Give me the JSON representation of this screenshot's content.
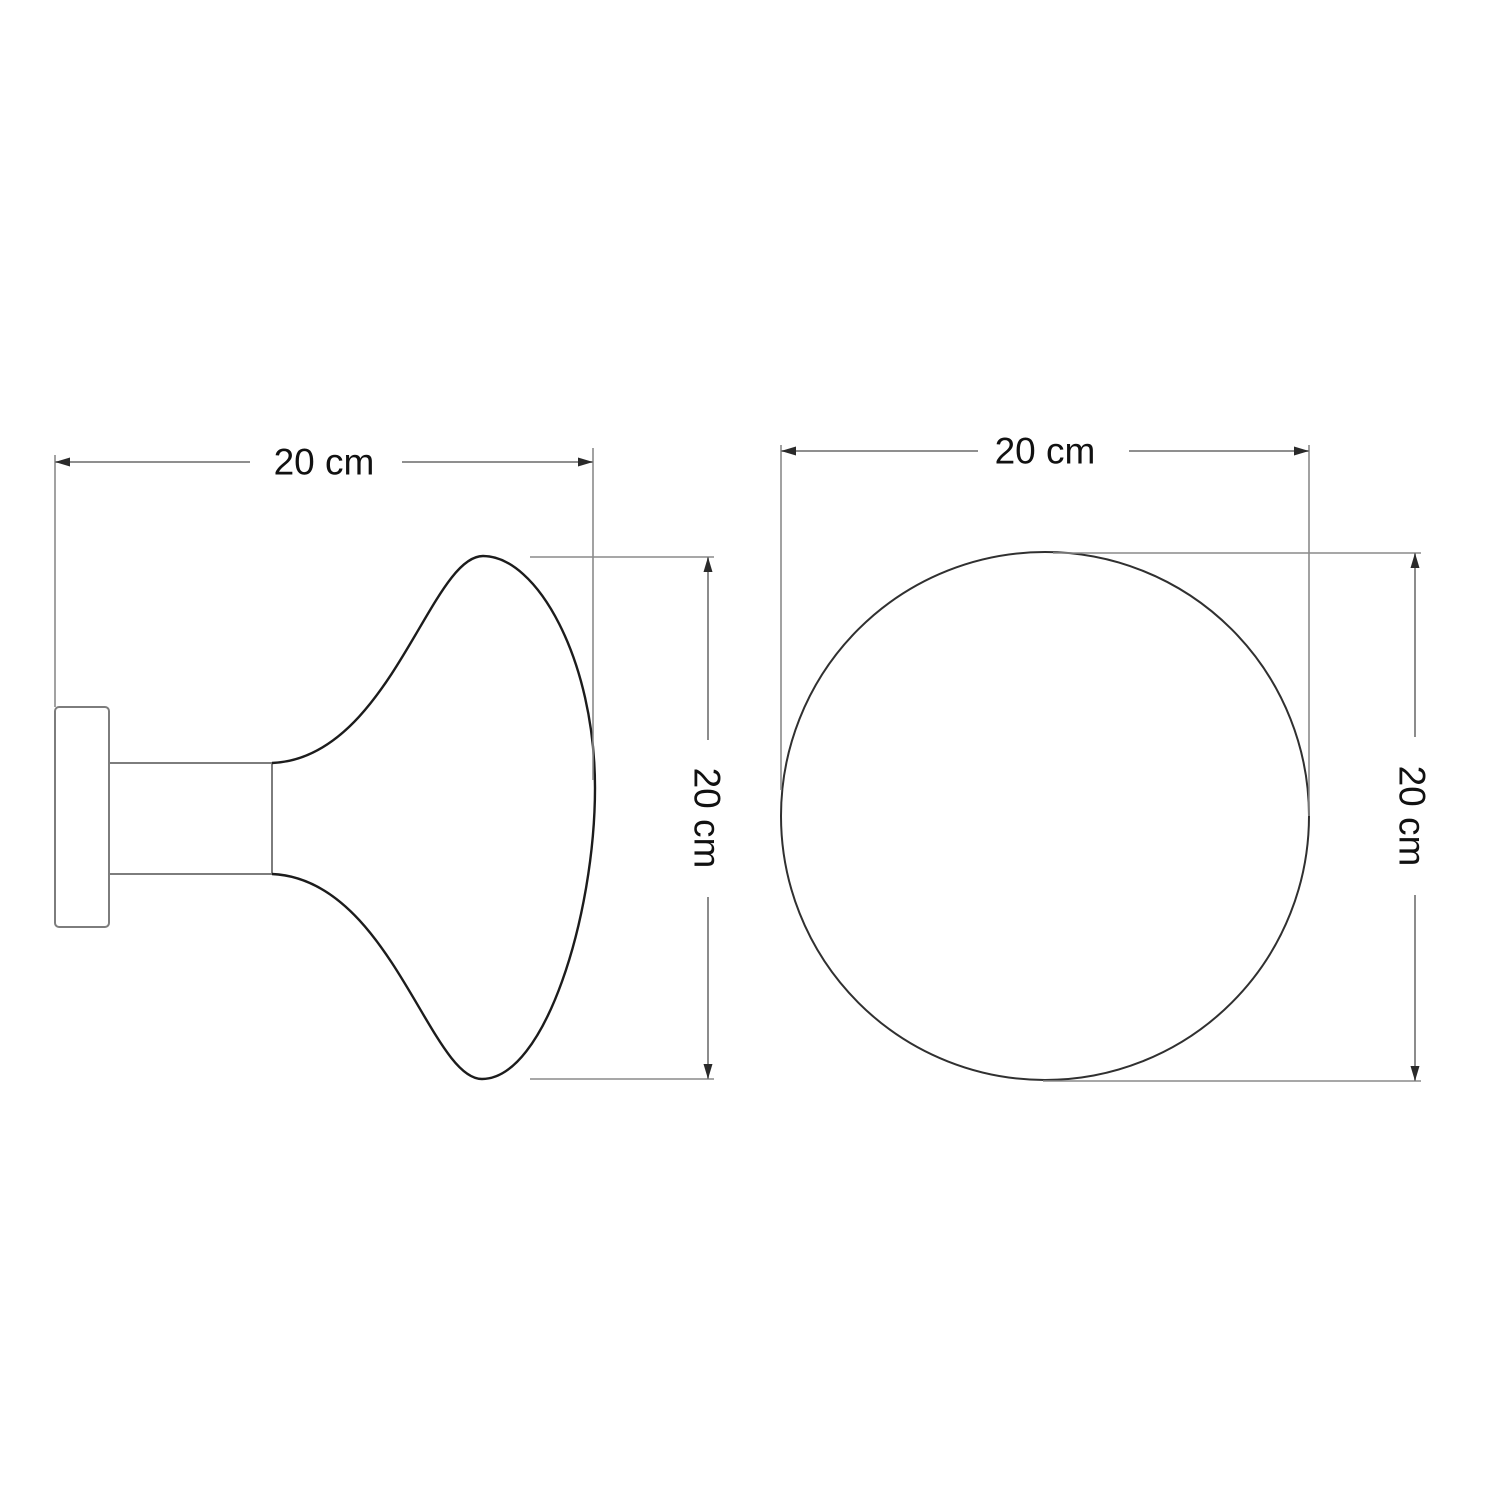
{
  "figure": {
    "side_view": {
      "width_label": "20 cm",
      "height_label": "20 cm"
    },
    "front_view": {
      "width_label": "20 cm",
      "height_label": "20 cm"
    }
  },
  "colors": {
    "background": "#ffffff",
    "shape_outline": "#1c1c1c",
    "circle_outline": "#303030",
    "dimension_lines": "#7f7f7f",
    "label_text": "#111111"
  }
}
